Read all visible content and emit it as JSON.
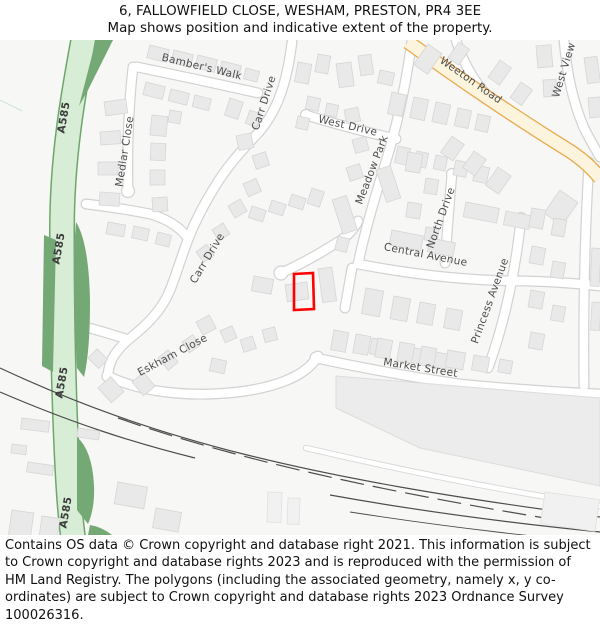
{
  "header": {
    "title": "6, FALLOWFIELD CLOSE, WESHAM, PRESTON, PR4 3EE",
    "subtitle": "Map shows position and indicative extent of the property."
  },
  "map": {
    "street_labels": [
      "Bamber's Walk",
      "Carr Drive",
      "Medlar Close",
      "West Drive",
      "Meadow Park",
      "Weeton Road",
      "West View",
      "North Drive",
      "Central Avenue",
      "Princess Avenue",
      "Carr Drive",
      "Eskham Close",
      "Market Street"
    ],
    "route_labels": [
      "A585",
      "A585",
      "A585",
      "A585"
    ],
    "colors": {
      "property_marker": "#ff0000",
      "a_road_fill": "#d8edd6",
      "a_road_border": "#6da66d",
      "main_road_fill": "#fcf4dc",
      "main_road_border": "#eaa94f",
      "greenery": "#74a874",
      "building_fill": "#e9e9e9",
      "map_background": "#f7f7f5"
    }
  },
  "footer": {
    "attribution": "Contains OS data © Crown copyright and database right 2021. This information is subject to Crown copyright and database rights 2023 and is reproduced with the permission of HM Land Registry. The polygons (including the associated geometry, namely x, y co-ordinates) are subject to Crown copyright and database rights 2023 Ordnance Survey 100026316."
  }
}
